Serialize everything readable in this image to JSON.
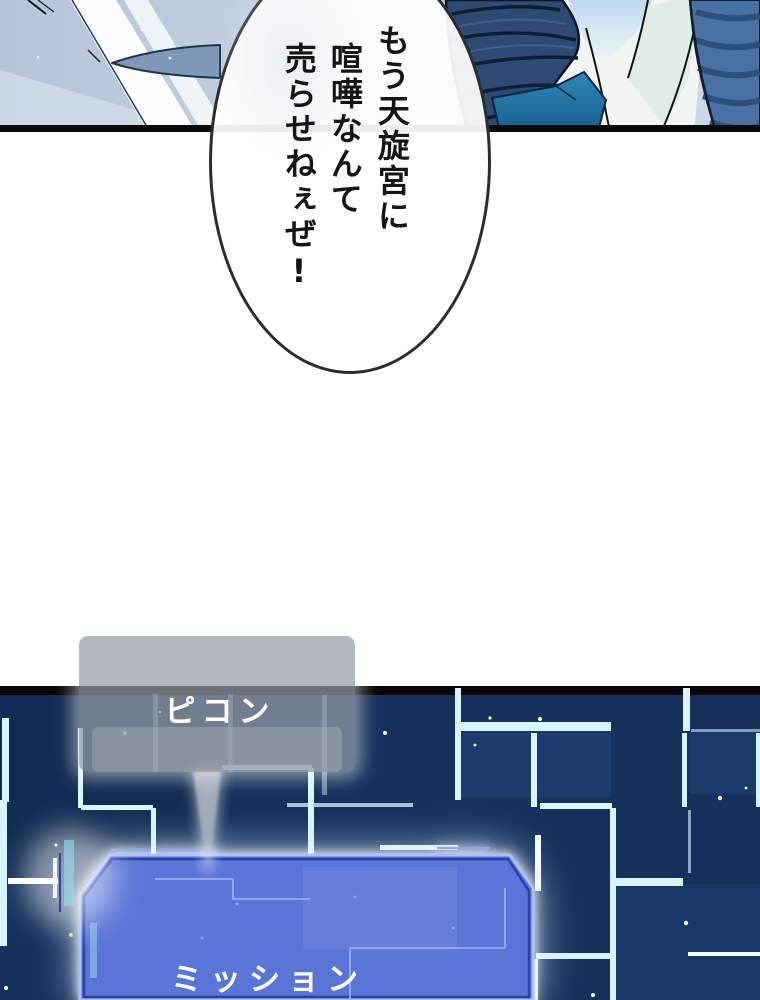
{
  "speech_bubble": {
    "full_text": "もう天旋宮に喧嘩なんて売らせねぇぜ!",
    "columns": [
      "もう天旋宮に",
      "喧嘩なんて",
      "売らせねぇぜ!"
    ]
  },
  "sfx": {
    "label": "ピコン"
  },
  "mission_panel": {
    "label": "ミッション"
  },
  "colors": {
    "panel_blue": "#5975d8",
    "panel_border_light": "#aebff2",
    "panel_border_dark": "#2b41a6",
    "circuit_cyan": "#d9f4fc",
    "background_navy": "#15315c",
    "divider_black": "#0a0a0a",
    "sfx_grey": "#979da3",
    "bubble_text": "#151515"
  }
}
